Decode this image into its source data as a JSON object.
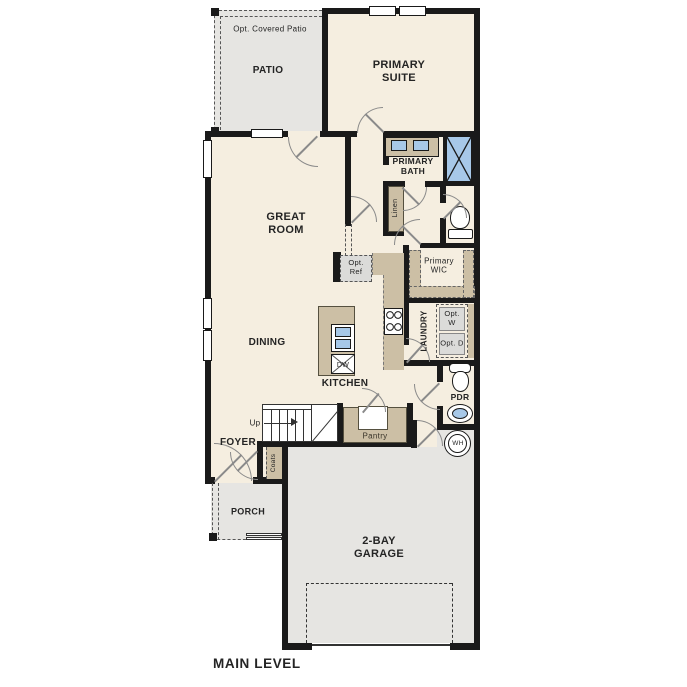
{
  "title": "MAIN LEVEL",
  "colors": {
    "floor_beige": "#f5eee0",
    "outdoor_gray": "#e6e5e2",
    "cabinet_tan": "#ccbfa5",
    "fixture_blue": "#a7c8e8",
    "wall_black": "#1a1a1a"
  },
  "labels": {
    "opt_covered_patio": "Opt. Covered Patio",
    "patio": "PATIO",
    "primary_suite": "PRIMARY SUITE",
    "primary_bath": "PRIMARY BATH",
    "linen": "Linen",
    "great_room": "GREAT ROOM",
    "primary_wic": "Primary WIC",
    "opt_ref": "Opt. Ref",
    "dining": "DINING",
    "kitchen": "KITCHEN",
    "laundry": "LAUNDRY",
    "opt_w": "Opt. W",
    "opt_d": "Opt. D",
    "pdr": "PDR",
    "wh": "WH",
    "dw": "DW",
    "up": "Up",
    "pantry": "Pantry",
    "foyer": "FOYER",
    "coats": "Coats",
    "porch": "PORCH",
    "garage": "2-BAY GARAGE",
    "main_level": "MAIN LEVEL"
  }
}
